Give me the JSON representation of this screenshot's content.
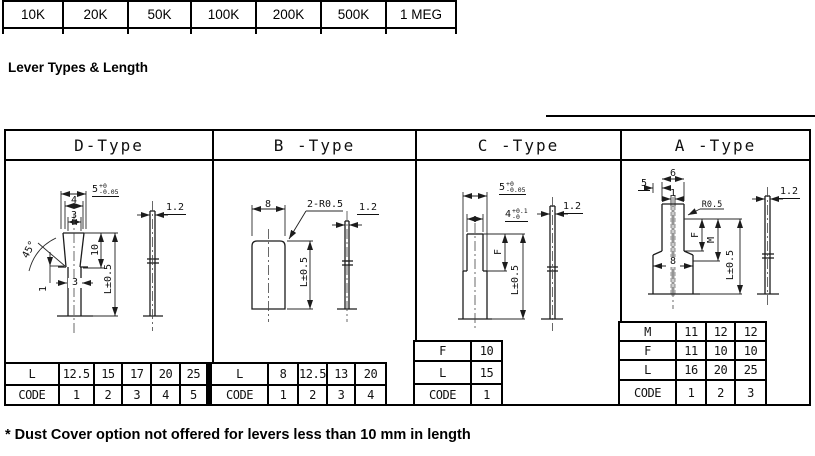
{
  "resistance_table": {
    "values": [
      "10K",
      "20K",
      "50K",
      "100K",
      "200K",
      "500K",
      "1 MEG"
    ]
  },
  "heading": "Lever Types & Length",
  "footnote": "* Dust Cover option not offered for levers less than 10 mm in length",
  "panels": [
    {
      "id": "d-type",
      "title": "D-Type",
      "dims": {
        "overall_width": "5",
        "overall_width_tol_plus": "+0",
        "overall_width_tol_minus": "-0.05",
        "mid_width": "4",
        "tip_width": "3",
        "taper_length": "10",
        "length": "L±0.5",
        "chamfer_angle": "45°",
        "notch": "1",
        "shaft_width": "3",
        "thickness": "1.2"
      },
      "table": {
        "rows": [
          {
            "label": "L",
            "cells": [
              "12.5",
              "15",
              "17",
              "20",
              "25"
            ]
          },
          {
            "label": "CODE",
            "cells": [
              "1",
              "2",
              "3",
              "4",
              "5"
            ]
          }
        ]
      }
    },
    {
      "id": "b-type",
      "title": "B -Type",
      "dims": {
        "width": "8",
        "corner_radius": "2-R0.5",
        "length": "L±0.5",
        "thickness": "1.2"
      },
      "table": {
        "rows": [
          {
            "label": "L",
            "cells": [
              "8",
              "12.5",
              "13",
              "20"
            ]
          },
          {
            "label": "CODE",
            "cells": [
              "1",
              "2",
              "3",
              "4"
            ]
          }
        ]
      }
    },
    {
      "id": "c-type",
      "title": "C -Type",
      "dims": {
        "overall_width": "5",
        "overall_width_tol_plus": "+0",
        "overall_width_tol_minus": "-0.05",
        "tip_width": "4",
        "tip_width_tol_plus": "+0.1",
        "tip_width_tol_minus": "-0",
        "slot_length": "F",
        "length": "L±0.5",
        "thickness": "1.2"
      },
      "table": {
        "rows": [
          {
            "label": "F",
            "cells": [
              "10"
            ]
          },
          {
            "label": "L",
            "cells": [
              "15"
            ]
          },
          {
            "label": "CODE",
            "cells": [
              "1"
            ]
          }
        ]
      }
    },
    {
      "id": "a-type",
      "title": "A -Type",
      "dims": {
        "top_width": "6",
        "side_width": "5",
        "slot_width": "1",
        "corner_radius": "R0.5",
        "slot_length_f": "F",
        "slot_length_m": "M",
        "base_width": "8",
        "length": "L±0.5",
        "thickness": "1.2"
      },
      "table": {
        "rows": [
          {
            "label": "M",
            "cells": [
              "11",
              "12",
              "12"
            ]
          },
          {
            "label": "F",
            "cells": [
              "11",
              "10",
              "10"
            ]
          },
          {
            "label": "L",
            "cells": [
              "16",
              "20",
              "25"
            ]
          },
          {
            "label": "CODE",
            "cells": [
              "1",
              "2",
              "3"
            ]
          }
        ]
      }
    }
  ]
}
